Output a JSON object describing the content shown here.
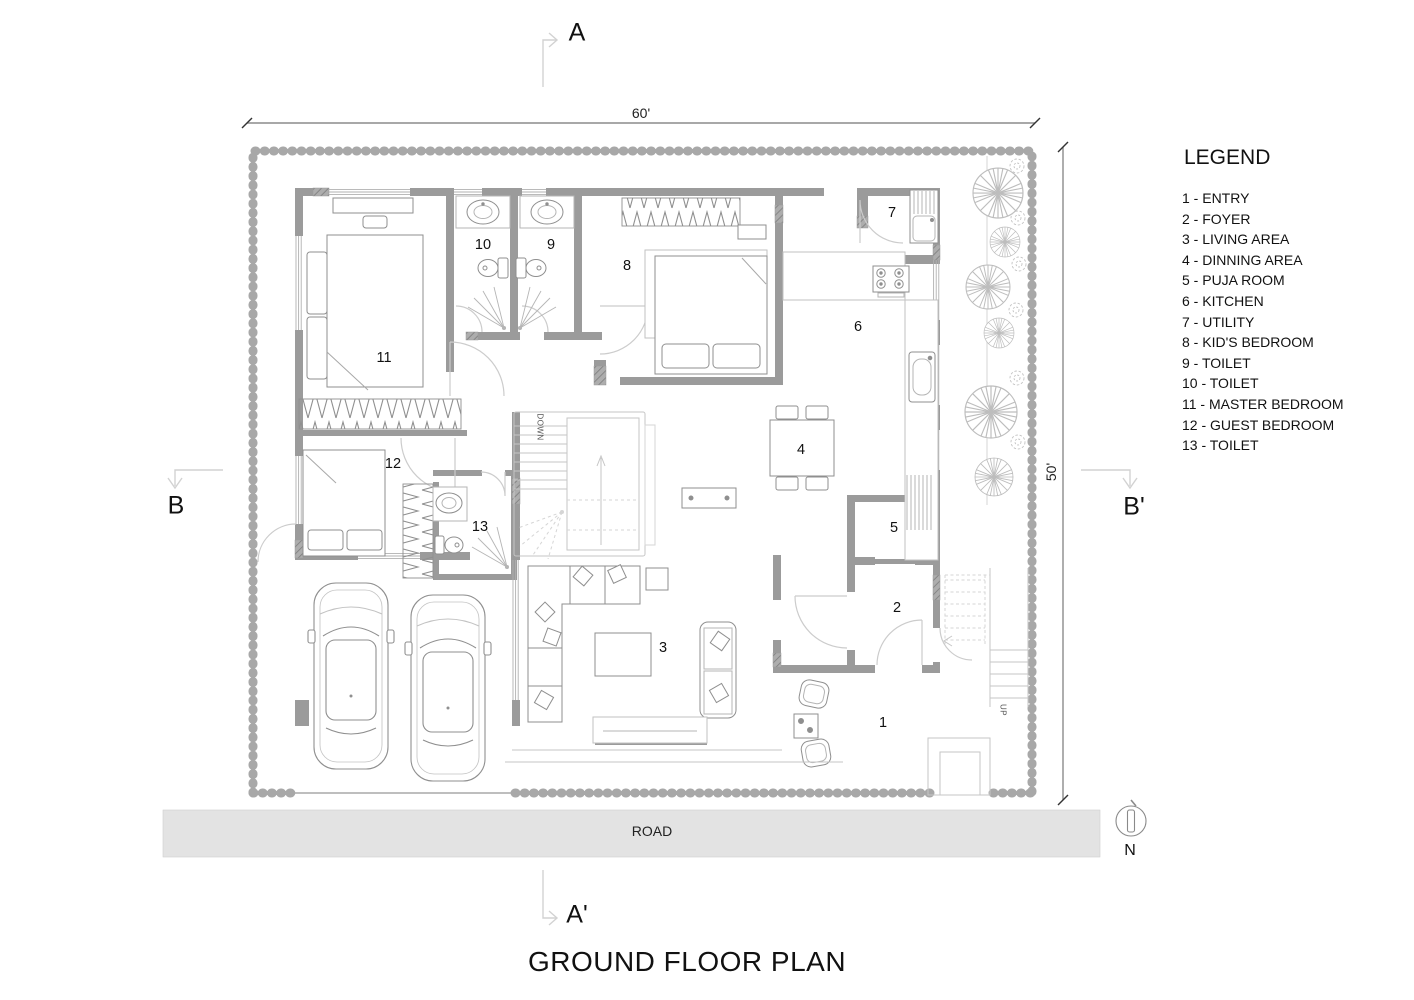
{
  "title": "GROUND FLOOR PLAN",
  "road_label": "ROAD",
  "north_label": "N",
  "dimensions": {
    "width_label": "60'",
    "depth_label": "50'"
  },
  "section_markers": {
    "top": "A",
    "bottom": "A'",
    "left": "B",
    "right": "B'"
  },
  "legend": {
    "heading": "LEGEND",
    "items": [
      "1 - ENTRY",
      "2 - FOYER",
      "3 - LIVING AREA",
      "4 - DINNING AREA",
      "5 - PUJA ROOM",
      "6 - KITCHEN",
      "7 - UTILITY",
      "8 - KID'S BEDROOM",
      "9 - TOILET",
      "10 - TOILET",
      "11 - MASTER BEDROOM",
      "12 - GUEST BEDROOM",
      "13 - TOILET"
    ]
  },
  "plan": {
    "rooms": [
      {
        "number": "1",
        "name": "ENTRY"
      },
      {
        "number": "2",
        "name": "FOYER"
      },
      {
        "number": "3",
        "name": "LIVING AREA"
      },
      {
        "number": "4",
        "name": "DINNING AREA"
      },
      {
        "number": "5",
        "name": "PUJA ROOM"
      },
      {
        "number": "6",
        "name": "KITCHEN"
      },
      {
        "number": "7",
        "name": "UTILITY"
      },
      {
        "number": "8",
        "name": "KID'S BEDROOM"
      },
      {
        "number": "9",
        "name": "TOILET"
      },
      {
        "number": "10",
        "name": "TOILET"
      },
      {
        "number": "11",
        "name": "MASTER BEDROOM"
      },
      {
        "number": "12",
        "name": "GUEST BEDROOM"
      },
      {
        "number": "13",
        "name": "TOILET"
      }
    ],
    "stair_labels": {
      "down": "DOWN",
      "up": "UP"
    },
    "colors": {
      "wall": "#9b9b9b",
      "boundary": "#a8a8a8",
      "road_fill": "#e3e3e3",
      "furniture_line": "#8f8f8f",
      "light_line": "#c6c6c6"
    }
  }
}
